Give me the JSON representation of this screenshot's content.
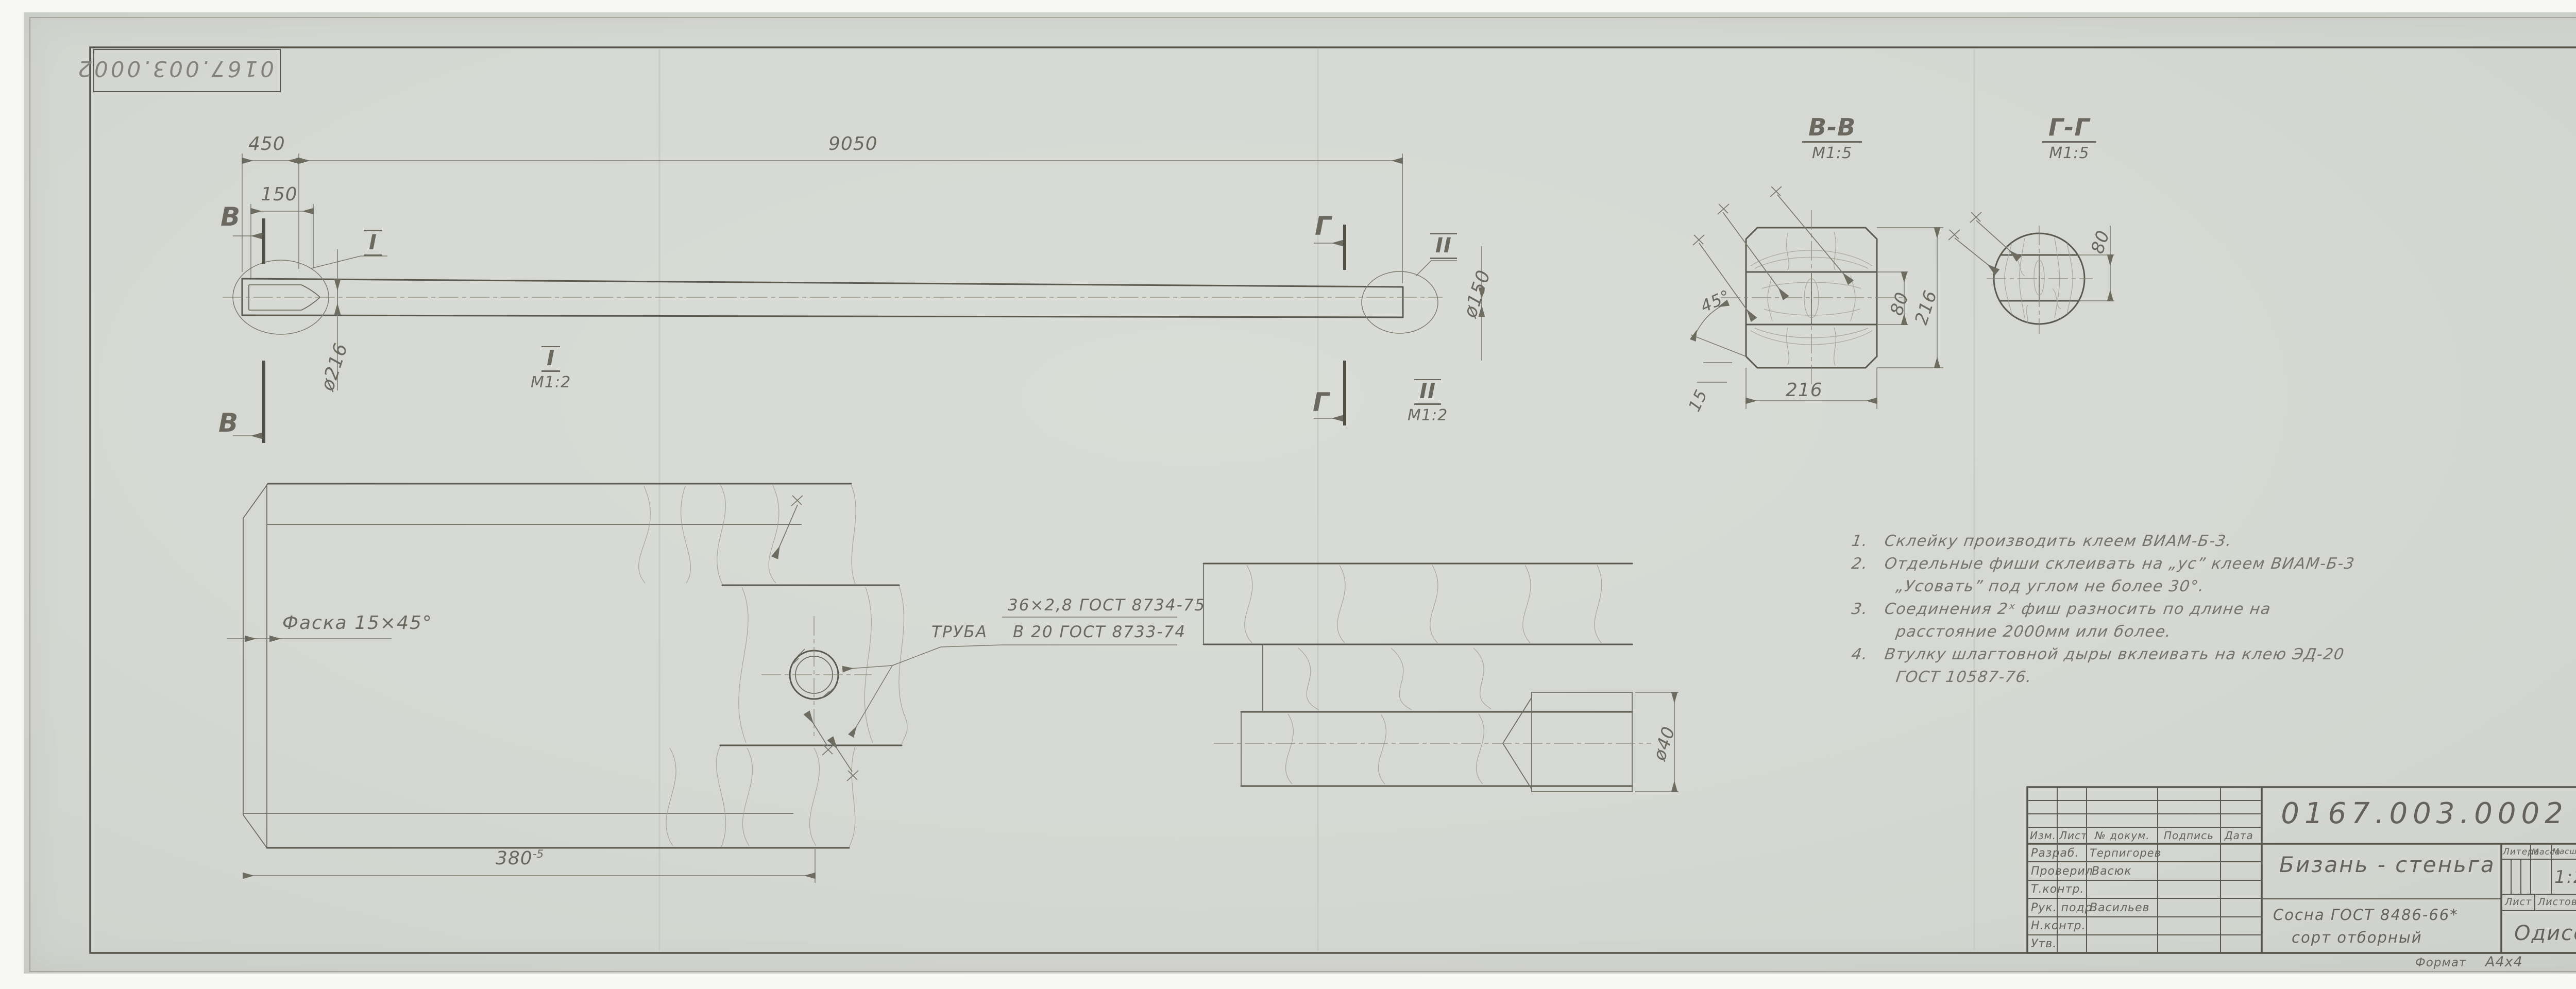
{
  "sheet": {
    "stamp_number": "0167.003.0002",
    "format_label": "Формат",
    "format_value": "А4х4"
  },
  "main_view": {
    "dim_450": "450",
    "dim_9050": "9050",
    "dim_150": "150",
    "dim_d216": "ø216",
    "dim_d150": "ø150",
    "section_b": "В",
    "section_g": "Г",
    "callout_i": "I",
    "callout_ii": "II"
  },
  "labels": {
    "detail_i": "I",
    "detail_i_scale": "М1:2",
    "detail_ii": "II",
    "detail_ii_scale": "М1:2",
    "section_bb": "В-В",
    "section_bb_scale": "М1:5",
    "section_gg": "Г-Г",
    "section_gg_scale": "М1:5"
  },
  "section_bb": {
    "dim_w": "216",
    "dim_h": "216",
    "dim_band": "80",
    "dim_angle": "45°",
    "dim_chamfer": "15"
  },
  "section_gg": {
    "dim_band": "80"
  },
  "detail_i": {
    "chamfer": "Фаска 15×45°",
    "tube_label": "ТРУБА",
    "tube_top": "36×2,8  ГОСТ 8734-75",
    "tube_bottom": "В 20  ГОСТ 8733-74",
    "dim_len": "380",
    "dim_len_tol": "-5"
  },
  "detail_ii": {
    "dim_d40": "ø40"
  },
  "notes": {
    "rows": [
      {
        "num": "1.",
        "text": "Склейку  производить  клеем  ВИАМ-Б-3."
      },
      {
        "num": "2.",
        "text": "Отдельные  фиши  склеивать  на „ус” клеем  ВИАМ-Б-3"
      },
      {
        "num": "",
        "text": "„Усовать” под  углом  не  более  30°."
      },
      {
        "num": "3.",
        "text": "Соединения  2ˣ фиш  разносить  по  длине  на"
      },
      {
        "num": "",
        "text": "расстояние   2000мм  или  более."
      },
      {
        "num": "4.",
        "text": "Втулку  шлагтовной  дыры  вклеивать  на  клею  ЭД-20"
      },
      {
        "num": "",
        "text": "ГОСТ 10587-76."
      }
    ]
  },
  "title_block": {
    "doc_number": "0167.003.0002",
    "part_name": "Бизань - стеньга",
    "cols": [
      "Изм.",
      "Лист",
      "№ докум.",
      "Подпись",
      "Дата"
    ],
    "rows": [
      {
        "label": "Разраб.",
        "name": "Терпигорев"
      },
      {
        "label": "Проверил",
        "name": "Васюк"
      },
      {
        "label": "Т.контр.",
        "name": ""
      },
      {
        "label": "Рук. подр.",
        "name": "Васильев"
      },
      {
        "label": "Н.контр.",
        "name": ""
      },
      {
        "label": "Утв.",
        "name": ""
      }
    ],
    "litera": "Литера",
    "mass": "Масса",
    "scale_label": "Масштаб",
    "scale": "1:25",
    "sheet_label": "Лист",
    "sheets_label": "Листов",
    "sheets_value": "1",
    "material_1": "Сосна  ГОСТ 8486-66*",
    "material_2": "сорт  отборный",
    "company": "Одиссей"
  }
}
